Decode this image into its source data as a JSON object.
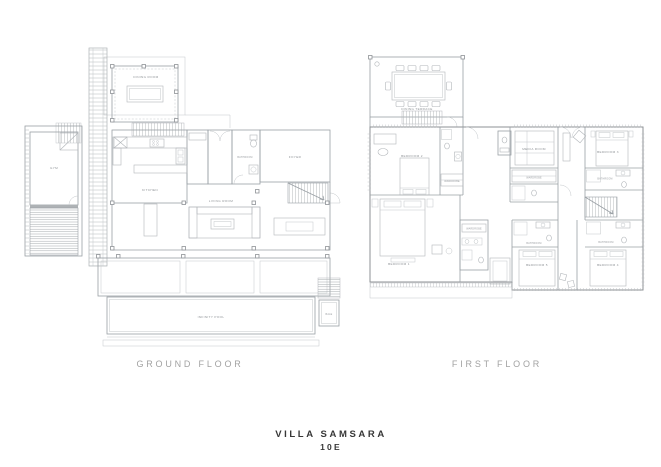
{
  "sheet": {
    "title": "VILLA SAMSARA",
    "unit": "10E"
  },
  "ground_floor": {
    "caption": "GROUND FLOOR",
    "labels": {
      "dining_room": "DINING ROOM",
      "gym": "GYM",
      "kitchen": "KITCHEN",
      "bathroom": "BATHROOM",
      "foyer": "FOYER",
      "living_room": "LIVING ROOM",
      "infinity_pool": "INFINITY POOL",
      "bale": "BALE"
    }
  },
  "first_floor": {
    "caption": "FIRST FLOOR",
    "labels": {
      "dining_terrace": "DINING TERRACE",
      "bedroom_1": "BEDROOM 1",
      "bedroom_2": "BEDROOM 2",
      "bedroom_3": "BEDROOM 3",
      "bedroom_4": "BEDROOM 4",
      "bedroom_5": "BEDROOM 5",
      "media_room": "MEDIA ROOM",
      "bathroom": "BATHROOM",
      "wardrobe": "WARDROBE"
    }
  },
  "colors": {
    "background": "#ffffff",
    "wall_line": "#9aa0a5",
    "light_line": "#c3c7ca",
    "furniture_line": "#b2b6ba",
    "room_label": "#8f9397",
    "caption": "#a2a2a2",
    "title": "#373737"
  }
}
